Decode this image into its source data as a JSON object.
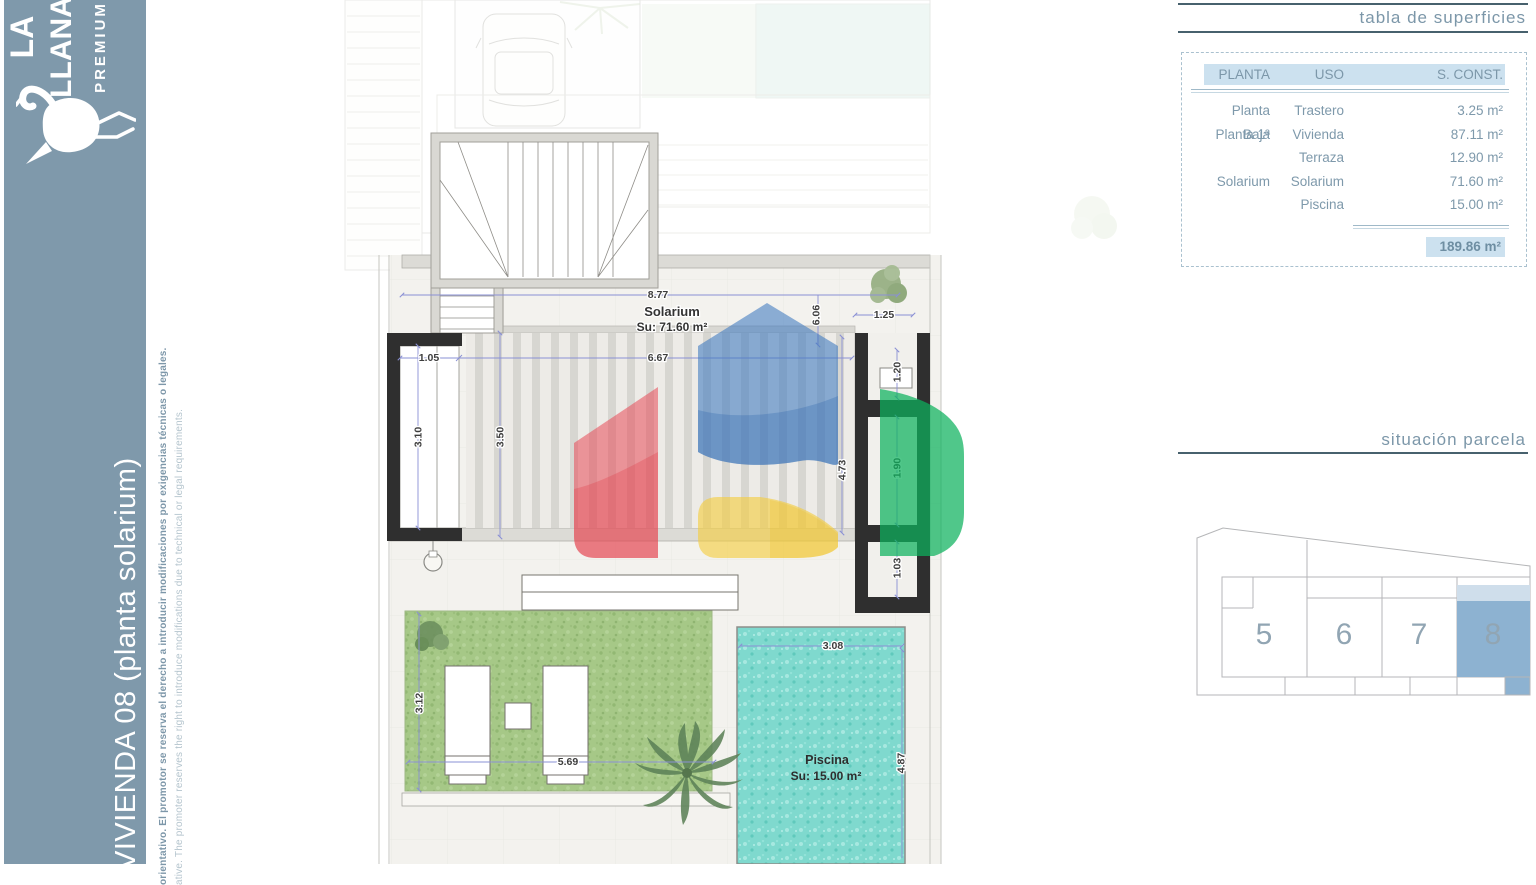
{
  "sidebar": {
    "brand": {
      "line1": "LA",
      "line2": "LLANA",
      "line3": "PREMIUM"
    },
    "title": "VIVIENDA 08 (planta solarium)",
    "disclaimer_es": "orientativo. El promotor se reserva el derecho a introducir modificaciones por exigencias técnicas o legales.",
    "disclaimer_en": "ative. The promoter reserves the right to introduce modifications due to technical or legal requirements."
  },
  "surfaces_table": {
    "title": "tabla de superficies",
    "headers": {
      "planta": "PLANTA",
      "uso": "USO",
      "sconst": "S. CONST."
    },
    "rows": [
      {
        "planta": "Planta Baja",
        "uso": "Trastero",
        "sconst": "3.25 m²"
      },
      {
        "planta": "Planta 1ª",
        "uso": "Vivienda",
        "sconst": "87.11 m²"
      },
      {
        "planta": "",
        "uso": "Terraza",
        "sconst": "12.90 m²"
      },
      {
        "planta": "Solarium",
        "uso": "Solarium",
        "sconst": "71.60 m²"
      },
      {
        "planta": "",
        "uso": "Piscina",
        "sconst": "15.00 m²"
      }
    ],
    "total": "189.86 m²"
  },
  "parcel": {
    "title": "situación parcela",
    "plots": [
      "5",
      "6",
      "7",
      "8"
    ],
    "highlighted_plot": "8"
  },
  "plan": {
    "solarium_label": "Solarium",
    "solarium_area": "Su: 71.60 m²",
    "pool_label": "Piscina",
    "pool_area": "Su: 15.00 m²",
    "dims": {
      "top_width": "8.77",
      "depth": "6.06",
      "shaft_width": "1.25",
      "window": "1.05",
      "pergola_width": "6.67",
      "left_height": "3.10",
      "inner_height": "3.50",
      "walk_height": "4.73",
      "room_mid": "1.90",
      "skylight": "1.20",
      "room_low": "1.03",
      "pool_width": "3.08",
      "grass_height": "3.12",
      "grass_width": "5.69",
      "pool_height": "4.87"
    }
  },
  "colors": {
    "sidebar": "#7F99AB",
    "accent_text": "#7C97A9",
    "highlight": "#CCE1EF",
    "rule": "#47616D",
    "plot_fill": "#8DB2D1",
    "plot_band": "#CFDEEB",
    "dim_line": "#8A90D4",
    "wall": "#2F2F2F",
    "pool": "#7FD9CE",
    "grass": "#A6C887",
    "logo_blue": "#3E79C0",
    "logo_red": "#E84B57",
    "logo_yellow": "#F3CD3E",
    "logo_green": "#0CB25D"
  }
}
